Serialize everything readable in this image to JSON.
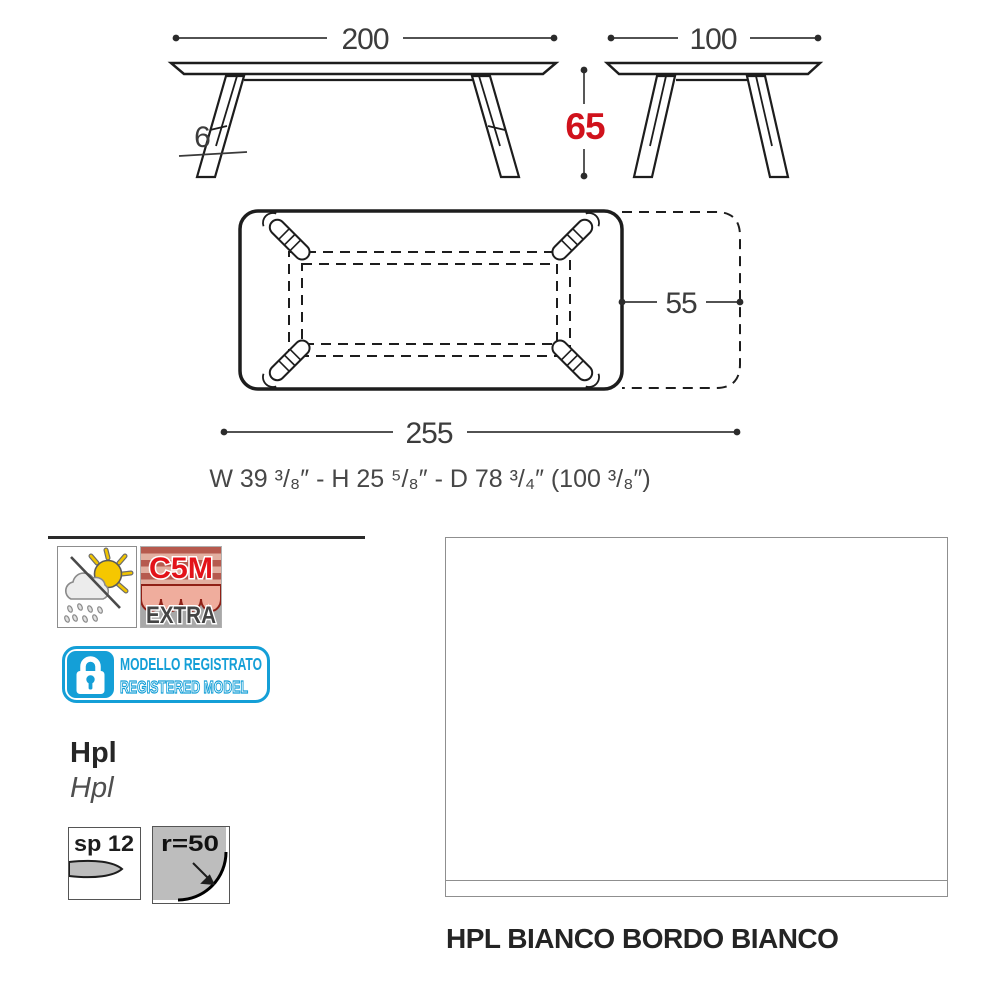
{
  "drawing": {
    "front": {
      "width": "200",
      "height": "65",
      "top_thickness": "6"
    },
    "side": {
      "depth": "100"
    },
    "top": {
      "extension_depth": "55",
      "total_length": "255"
    },
    "imperial": "W 39 ³/₈″ - H 25 ⁵/₈″  - D 78 ³/₄″ (100 ³/₈″)",
    "accent_red": "#d0121c"
  },
  "badges": {
    "outdoor_icon": "sun-cloud-rain-icon",
    "c5m": {
      "code": "C5M",
      "variant": "EXTRA",
      "code_color": "#e31219"
    },
    "registered": {
      "line1": "MODELLO REGISTRATO",
      "line2": "REGISTERED MODEL",
      "color": "#149fd7",
      "icon": "padlock-icon"
    }
  },
  "material": {
    "title": "Hpl",
    "subtitle": "Hpl",
    "thickness_label": "sp 12",
    "edge_radius_label": "r=50"
  },
  "finish": {
    "label": "HPL BIANCO BORDO BIANCO"
  }
}
